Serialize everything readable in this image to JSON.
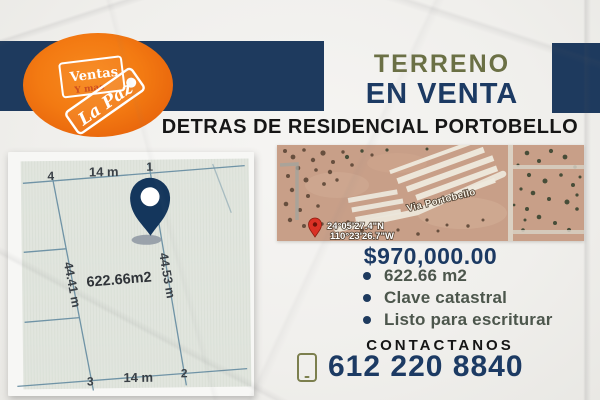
{
  "colors": {
    "navy": "#1e3a5e",
    "olive": "#6b7045",
    "orange": "#f0760f",
    "feature_text": "#4c564c",
    "pin_red": "#d93025"
  },
  "logo": {
    "tag_back_line1": "Ventas",
    "tag_back_line2": "Y mas",
    "tag_front": "La Paz"
  },
  "header": {
    "title_line1": "TERRENO",
    "title_line2": "EN VENTA",
    "subtitle": "DETRAS DE RESIDENCIAL PORTOBELLO"
  },
  "plan": {
    "corner_top_left": "4",
    "corner_top_right": "1",
    "corner_bottom_left": "3",
    "corner_bottom_right": "2",
    "top_length": "14 m",
    "bottom_length": "14 m",
    "left_length": "44.41 m",
    "right_length": "44.53 m",
    "area": "622.66m2"
  },
  "map": {
    "road_label": "Via Portobello",
    "coordinates_line1": "24°05'27.4\"N",
    "coordinates_line2": "110°23'26.7\"W"
  },
  "listing": {
    "price": "$970,000.00",
    "features": [
      "622.66 m2",
      "Clave catastral",
      "Listo para escriturar"
    ]
  },
  "contact": {
    "label": "CONTACTANOS",
    "phone": "612 220 8840"
  }
}
